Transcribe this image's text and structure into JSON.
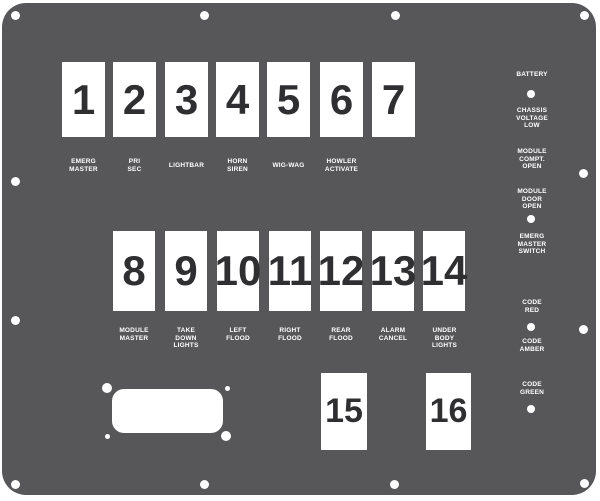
{
  "panel": {
    "description": "Emergency vehicle switch panel faceplate",
    "colors": {
      "plate": "#57575a",
      "cutout": "#ffffff",
      "digit": "#2f2f31",
      "label_text": "#ffffff"
    }
  },
  "switches": [
    {
      "number": "1",
      "lines": [
        "EMERG",
        "MASTER"
      ]
    },
    {
      "number": "2",
      "lines": [
        "PRI",
        "SEC"
      ]
    },
    {
      "number": "3",
      "lines": [
        "LIGHTBAR"
      ]
    },
    {
      "number": "4",
      "lines": [
        "HORN",
        "SIREN"
      ]
    },
    {
      "number": "5",
      "lines": [
        "WIG-WAG"
      ]
    },
    {
      "number": "6",
      "lines": [
        "HOWLER",
        "ACTIVATE"
      ]
    },
    {
      "number": "7",
      "lines": []
    },
    {
      "number": "8",
      "lines": [
        "MODULE",
        "MASTER"
      ]
    },
    {
      "number": "9",
      "lines": [
        "TAKE",
        "DOWN",
        "LIGHTS"
      ]
    },
    {
      "number": "10",
      "lines": [
        "LEFT",
        "FLOOD"
      ]
    },
    {
      "number": "11",
      "lines": [
        "RIGHT",
        "FLOOD"
      ]
    },
    {
      "number": "12",
      "lines": [
        "REAR",
        "FLOOD"
      ]
    },
    {
      "number": "13",
      "lines": [
        "ALARM",
        "CANCEL"
      ]
    },
    {
      "number": "14",
      "lines": [
        "UNDER",
        "BODY",
        "LIGHTS"
      ]
    },
    {
      "number": "15",
      "lines": []
    },
    {
      "number": "16",
      "lines": []
    }
  ],
  "indicators": [
    {
      "lines": [
        "BATTERY"
      ]
    },
    {
      "lines": [
        "CHASSIS",
        "VOLTAGE",
        "LOW"
      ]
    },
    {
      "lines": [
        "MODULE",
        "COMPT.",
        "OPEN"
      ]
    },
    {
      "lines": [
        "MODULE",
        "DOOR",
        "OPEN"
      ]
    },
    {
      "lines": [
        "EMERG",
        "MASTER",
        "SWITCH"
      ]
    },
    {
      "lines": [
        "CODE",
        "RED"
      ]
    },
    {
      "lines": [
        "CODE",
        "AMBER"
      ]
    },
    {
      "lines": [
        "CODE",
        "GREEN"
      ]
    }
  ]
}
